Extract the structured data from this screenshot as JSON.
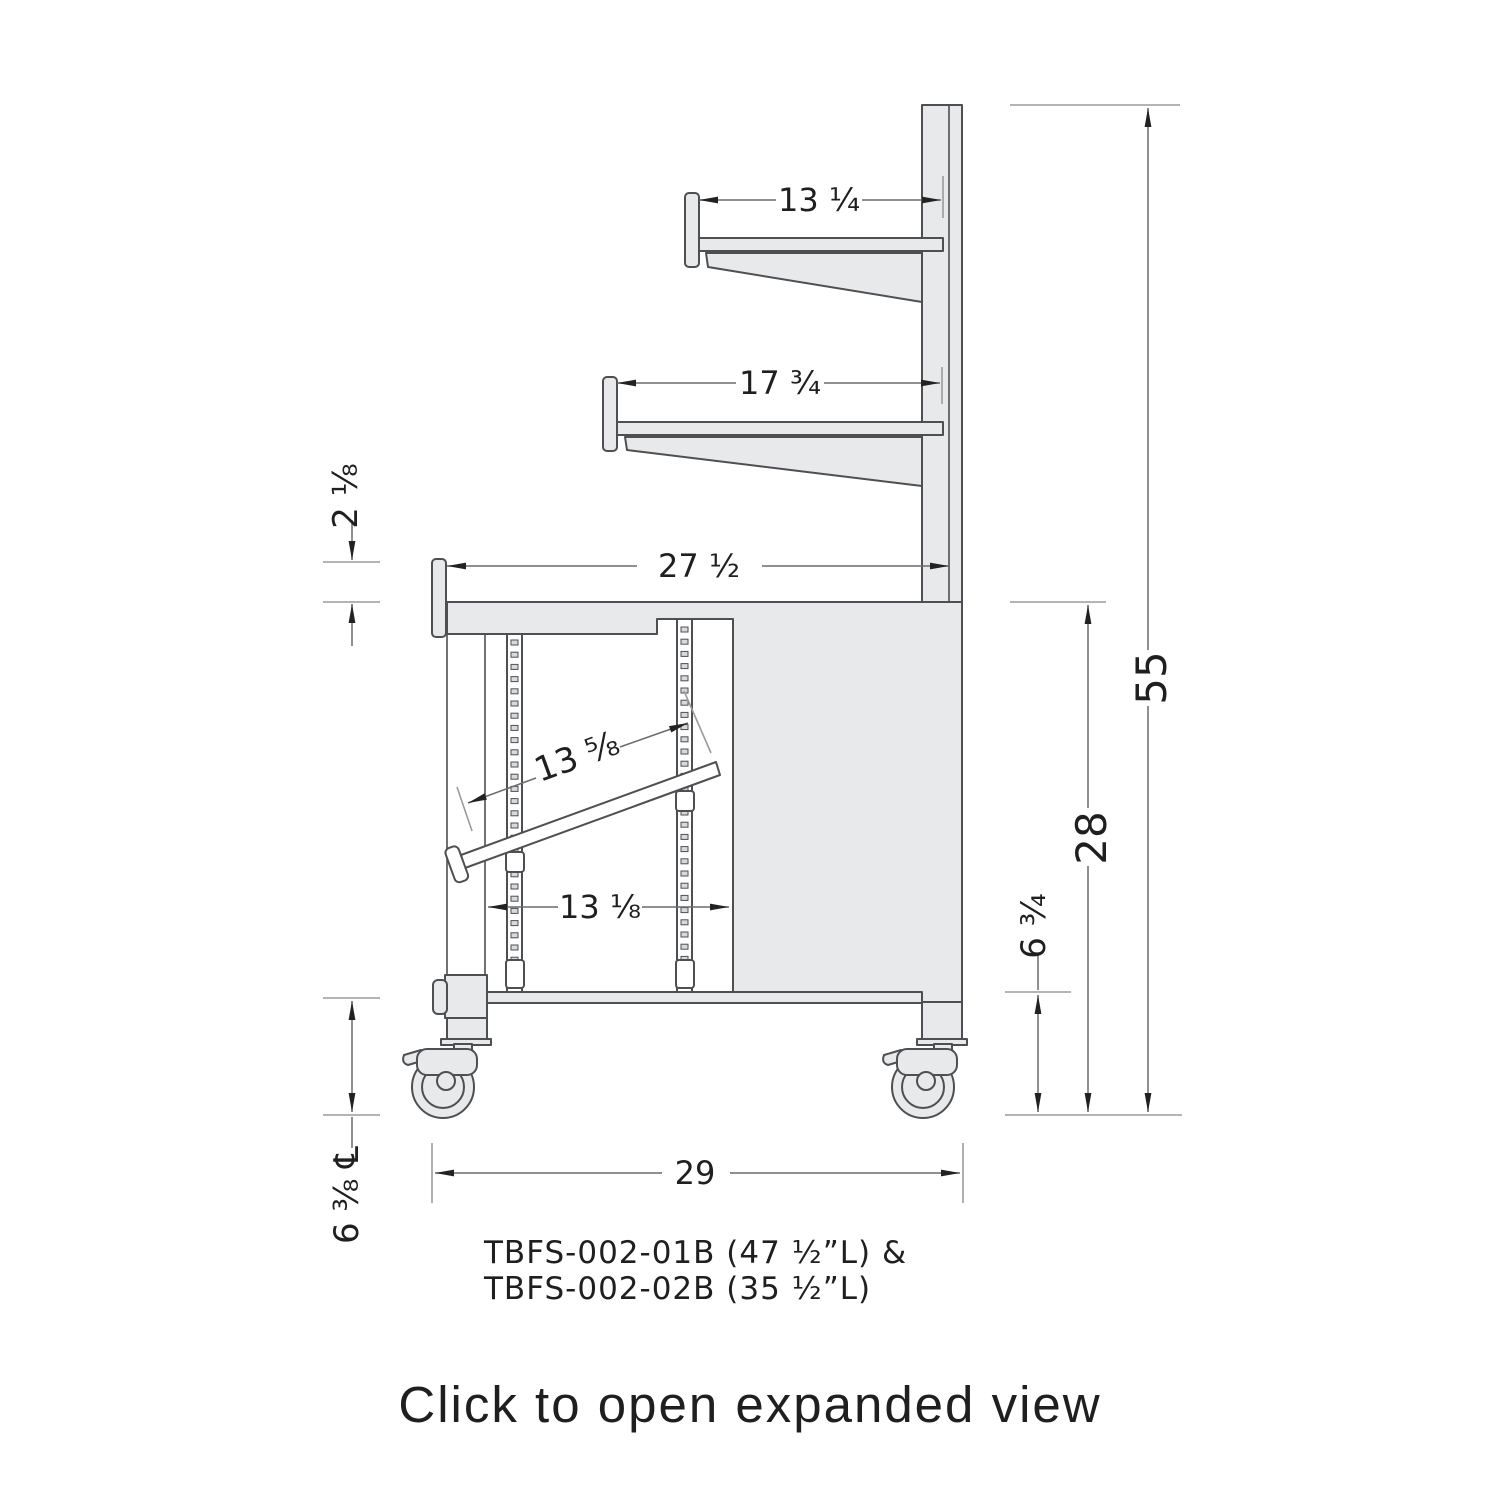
{
  "figure": {
    "footer_link": "Click to open expanded view",
    "caption": {
      "line1": "TBFS-002-01B (47 ½”L) &",
      "line2": "TBFS-002-02B (35 ½”L)"
    },
    "dimensions": {
      "top_shelf_depth": "13 ¼",
      "mid_shelf_depth": "17 ¾",
      "counter_depth": "27 ½",
      "rim_height": "2 ⅛",
      "tray_length": "13 ⅝",
      "rail_spacing": "13 ⅛",
      "overall_height": "55",
      "counter_height": "28",
      "bottom_shelf_height": "6 ¾",
      "caster_centerline_height": "6 ⅜ ℄",
      "base_depth": "29"
    },
    "colors": {
      "fill": "#e8e9ea",
      "stroke": "#4d4f52",
      "dim_line": "#6b6b6b",
      "extension_line": "#9b9b9b",
      "text": "#1f1f1f"
    }
  }
}
